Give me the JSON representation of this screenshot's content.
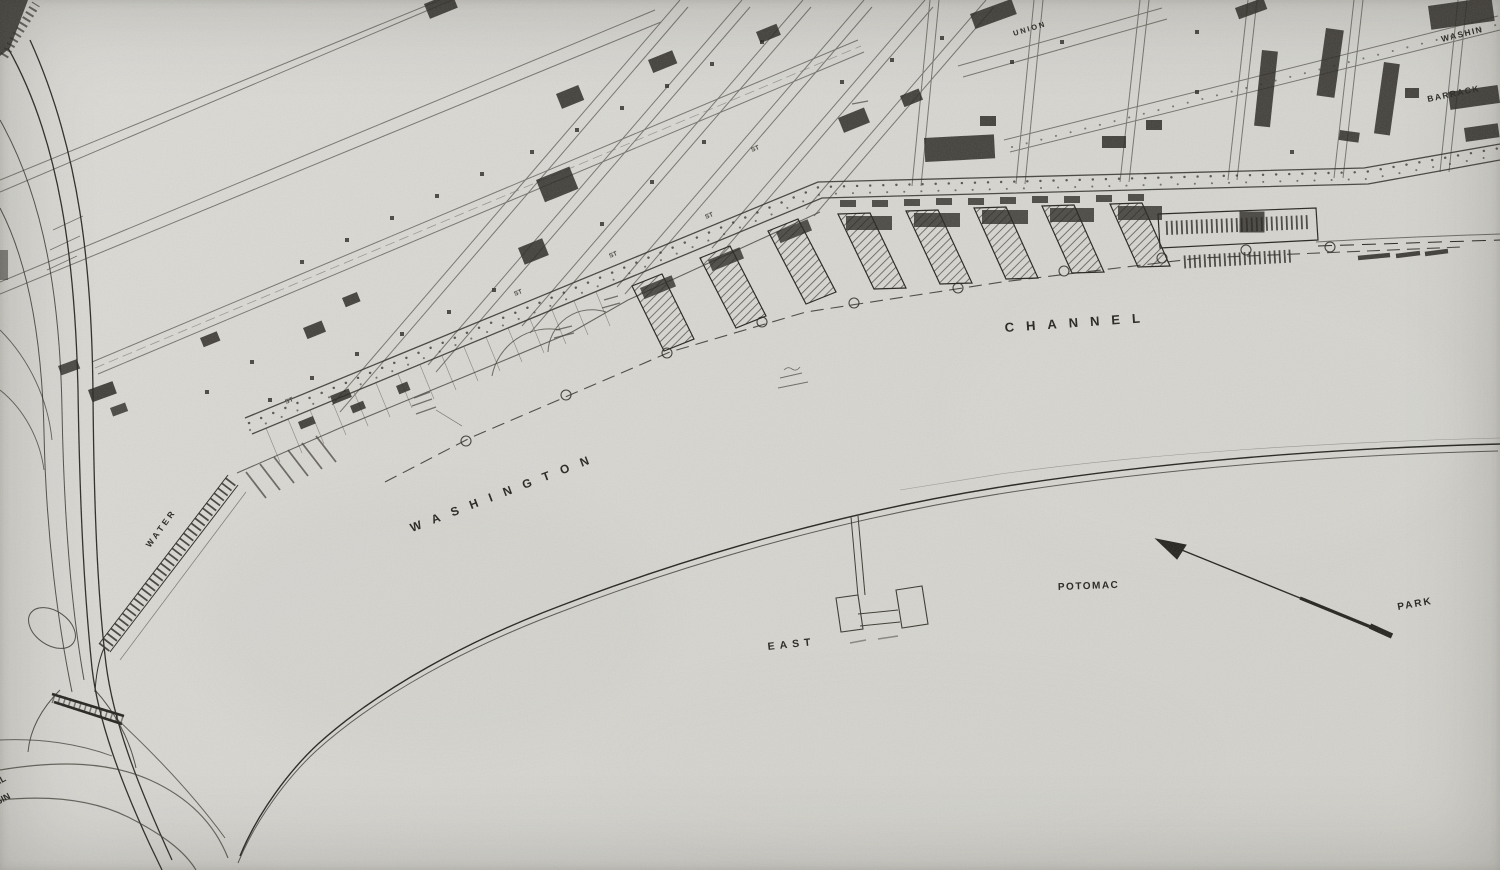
{
  "water_labels": {
    "washington": "WASHINGTON",
    "channel": "CHANNEL",
    "east": "EAST",
    "potomac": "POTOMAC",
    "park": "PARK"
  },
  "street_labels": {
    "water": "WATER",
    "union": "UNION",
    "st": "ST"
  },
  "place_labels": {
    "washington_partial": "WASHIN",
    "barracks_partial": "BARRACK",
    "edge_fragment_top": "AL",
    "edge_fragment_bottom": "ASIN"
  },
  "colors": {
    "paper": "#d8d7d2",
    "ink": "#26241f",
    "ink_light": "#6b685f"
  }
}
